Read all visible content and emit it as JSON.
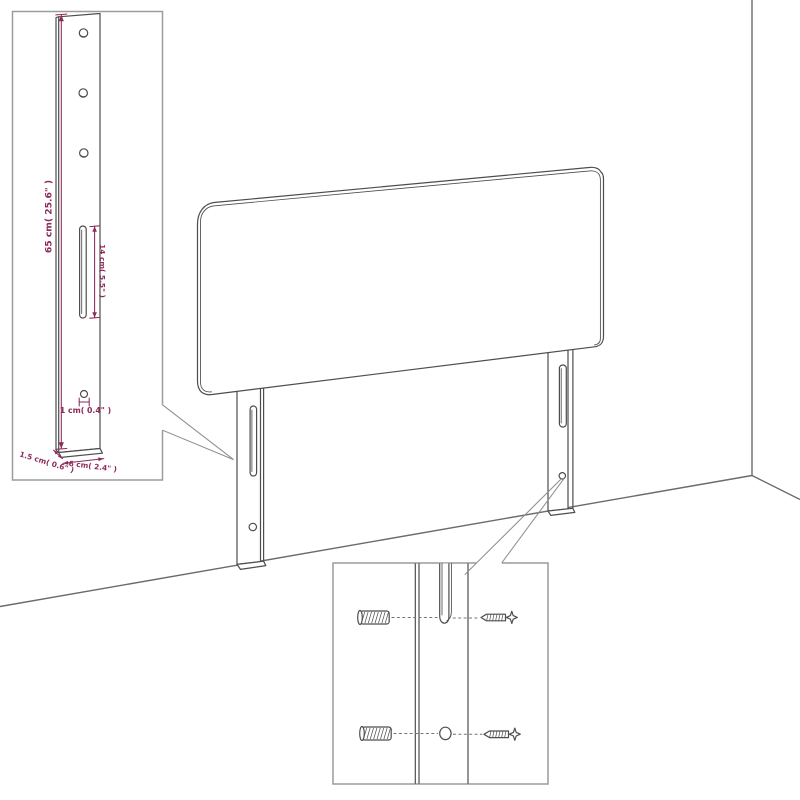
{
  "diagram": {
    "type": "product-line-drawing",
    "subject": "Headboard with two slotted legs shown against a wall corner, with a leg dimension inset and a wall-mounting hardware inset",
    "background": "#ffffff",
    "colors": {
      "line": "#4d4d4d",
      "wall_line": "#6b6b6b",
      "inset_border": "#9c9c9c",
      "leader_line": "#8f8f8f",
      "dimension": "#8c2a5c"
    },
    "scene": {
      "leg_count": 2,
      "slots_per_leg": 1,
      "screw_holes_per_leg": 1
    },
    "leg_dimension_inset": {
      "height_label": "65 cm( 25.6\" )",
      "slot_label": "14 cm( 5.5\" )",
      "hole_label": "1 cm( 0.4\" )",
      "thickness_label": "1.5 cm( 0.6\" )",
      "width_label": "6 cm( 2.4\" )",
      "top_hole_count": 3
    },
    "hardware_inset": {
      "wall_plug_count": 2,
      "screw_count": 2
    }
  }
}
